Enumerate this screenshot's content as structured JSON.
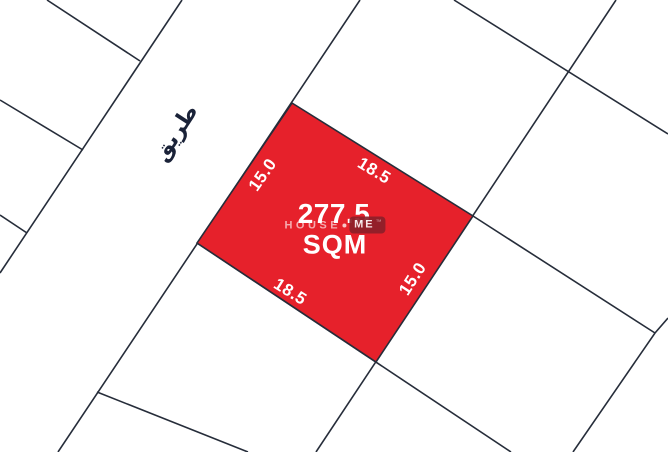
{
  "map": {
    "road": {
      "label": "طريق"
    },
    "highlighted_plot": {
      "area_value": "277.5",
      "area_unit": "SQM",
      "edge_labels": {
        "top_left": "15.0",
        "top_right": "18.5",
        "bottom_left": "18.5",
        "bottom_right": "15.0"
      }
    },
    "watermark": {
      "brand_first": "HOUSE",
      "brand_second": "ME",
      "trademark": "™"
    }
  },
  "colors": {
    "plot_fill": "#e6212b",
    "map_line": "#262d3a",
    "dimension_text": "#ffffff",
    "road_text": "#1a2238",
    "watermark_box": "#8c1f29"
  }
}
